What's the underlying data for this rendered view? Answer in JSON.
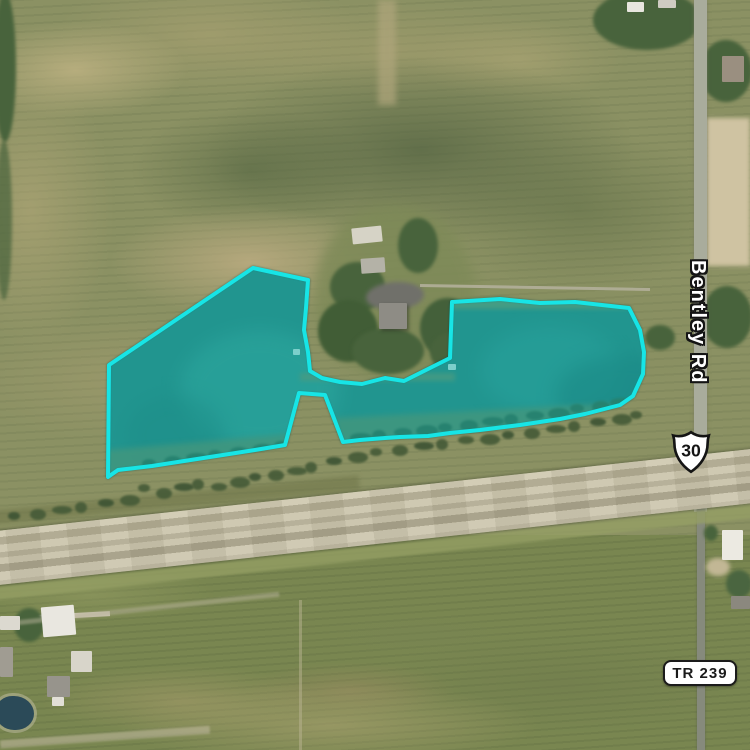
{
  "map": {
    "type": "satellite-aerial",
    "labels": {
      "road_vertical": "Bentley Rd",
      "route_shield": "30",
      "township_road": "TR 239"
    },
    "icons": {
      "route_marker": "us-route-shield-icon"
    },
    "parcel": {
      "outline_points": "253,268 308,280 306,308 304,330 308,352 310,371 322,378 340,382 362,384 385,378 404,381 450,358 452,302 500,299 540,303 575,302 629,308 640,330 644,352 643,374 633,396 620,405 585,414 560,419 520,425 480,430 450,433 428,436 400,437 385,438 360,440 343,442 325,395 299,393 285,445 255,450 210,457 152,466 118,470 108,477 109,365",
      "stroke_color": "#17E5E6",
      "fill_color": "rgba(34,216,210,0.38)"
    },
    "colors": {
      "highlight_cyan": "#17E5E6",
      "pond_water": "#2b7a72",
      "field_north": "#8B9163",
      "field_south": "#798650",
      "highway_surface": "#CCC6AF",
      "local_road": "#A9AC9C"
    }
  }
}
